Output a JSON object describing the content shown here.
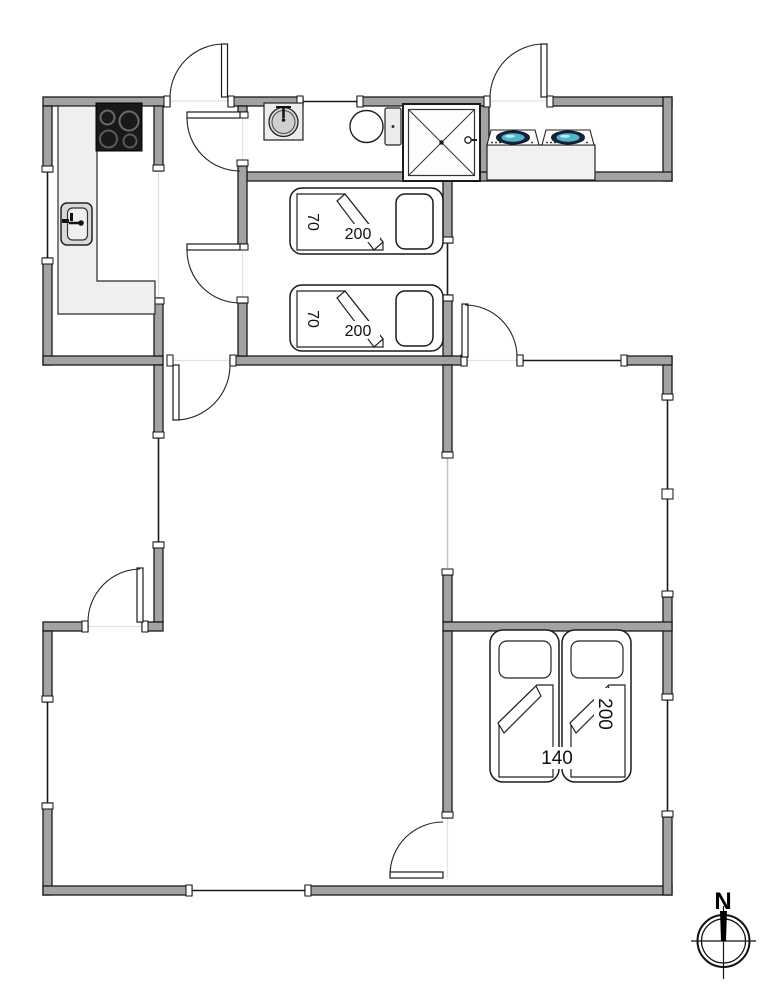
{
  "title": "holiday-home-floor-plan",
  "beds": {
    "single_1": {
      "width_cm": "70",
      "length_cm": "200"
    },
    "single_2": {
      "width_cm": "70",
      "length_cm": "200"
    },
    "double": {
      "width_cm": "140",
      "length_cm": "200"
    }
  },
  "compass": {
    "north": "N"
  },
  "fixtures": [
    "stove-cooktop",
    "kitchen-sink",
    "kitchen-counter",
    "washbasin",
    "toilet",
    "shower",
    "washing-machine",
    "tumble-dryer",
    "single-bed",
    "single-bed",
    "double-bed",
    "compass-rose"
  ],
  "colors": {
    "wall_fill": "#a3a3a3",
    "outline": "#1a1a1a",
    "counter_fill": "#efefef",
    "stove_fill": "#191919",
    "washer_door_ring": "#172440",
    "washer_door_glass": "#4fb6c8",
    "floor": "#ffffff"
  }
}
